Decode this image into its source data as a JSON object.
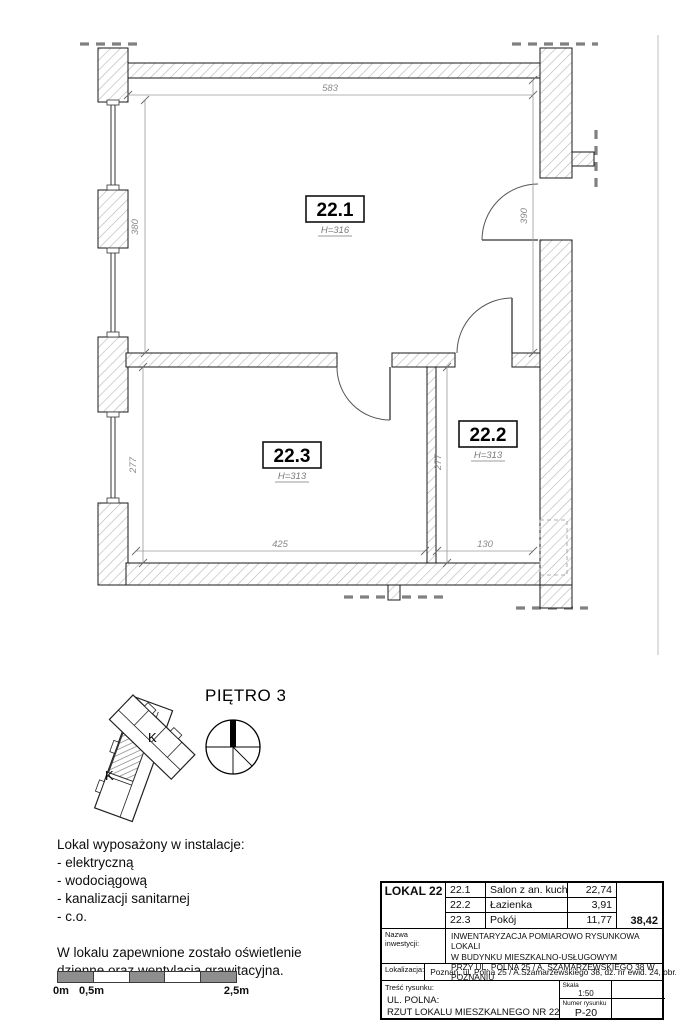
{
  "plan": {
    "rooms": [
      {
        "id": "22.1",
        "h": "H=316"
      },
      {
        "id": "22.2",
        "h": "H=313"
      },
      {
        "id": "22.3",
        "h": "H=313"
      }
    ],
    "dims": {
      "top": "583",
      "left_upper": "380",
      "right_upper": "390",
      "left_lower": "277",
      "mid_lower": "277",
      "bottom_left": "425",
      "bottom_right": "130"
    }
  },
  "keyplan": {
    "floor_label": "PIĘTRO 3",
    "stair_label_1": "K",
    "stair_label_2": "K"
  },
  "notes": {
    "install_title": "Lokal wyposażony w instalacje:",
    "install_items": [
      "- elektryczną",
      "- wodociągową",
      "- kanalizacji sanitarnej",
      "- c.o."
    ],
    "lighting_line1": "W lokalu zapewnione zostało oświetlenie",
    "lighting_line2": "dzienne oraz wentylacja grawitacyjna."
  },
  "scalebar": {
    "label_0": "0m",
    "label_05": "0,5m",
    "label_25": "2,5m"
  },
  "titleblock": {
    "lokal": "LOKAL 22",
    "rows": [
      {
        "no": "22.1",
        "name": "Salon z an. kuch.",
        "area": "22,74"
      },
      {
        "no": "22.2",
        "name": "Łazienka",
        "area": "3,91"
      },
      {
        "no": "22.3",
        "name": "Pokój",
        "area": "11,77"
      }
    ],
    "total": "38,42",
    "nazwa_label": "Nazwa\ninwestycji:",
    "nazwa_line1": "INWENTARYZACJA POMIAROWO RYSUNKOWA LOKALI",
    "nazwa_line2": "W BUDYNKU MIESZKALNO-USŁUGOWYM",
    "nazwa_line3": "PRZY UL. POLNA 25 / A. SZAMARZEWSKIEGO 38 W POZNANIU",
    "lokalizacja_label": "Lokalizacja:",
    "lokalizacja": "Poznań, ul. Polna 25 / A.Szamarzewskiego 38, dz. nr ewid. 24, obr. Wilda",
    "tresc_label": "Treść rysunku:",
    "tresc_line1": "UL. POLNA:",
    "tresc_line2": "RZUT LOKALU MIESZKALNEGO NR 22",
    "skala_label": "Skala",
    "skala_value": "1:50",
    "numer_label": "Numer rysunku",
    "numer_value": "P-20"
  },
  "colors": {
    "wall_hatch": "#b5b5b5",
    "dimension": "#8a8a8a",
    "continuation_dash": "#808080",
    "scalebar_fill": "#8e8e8e"
  }
}
